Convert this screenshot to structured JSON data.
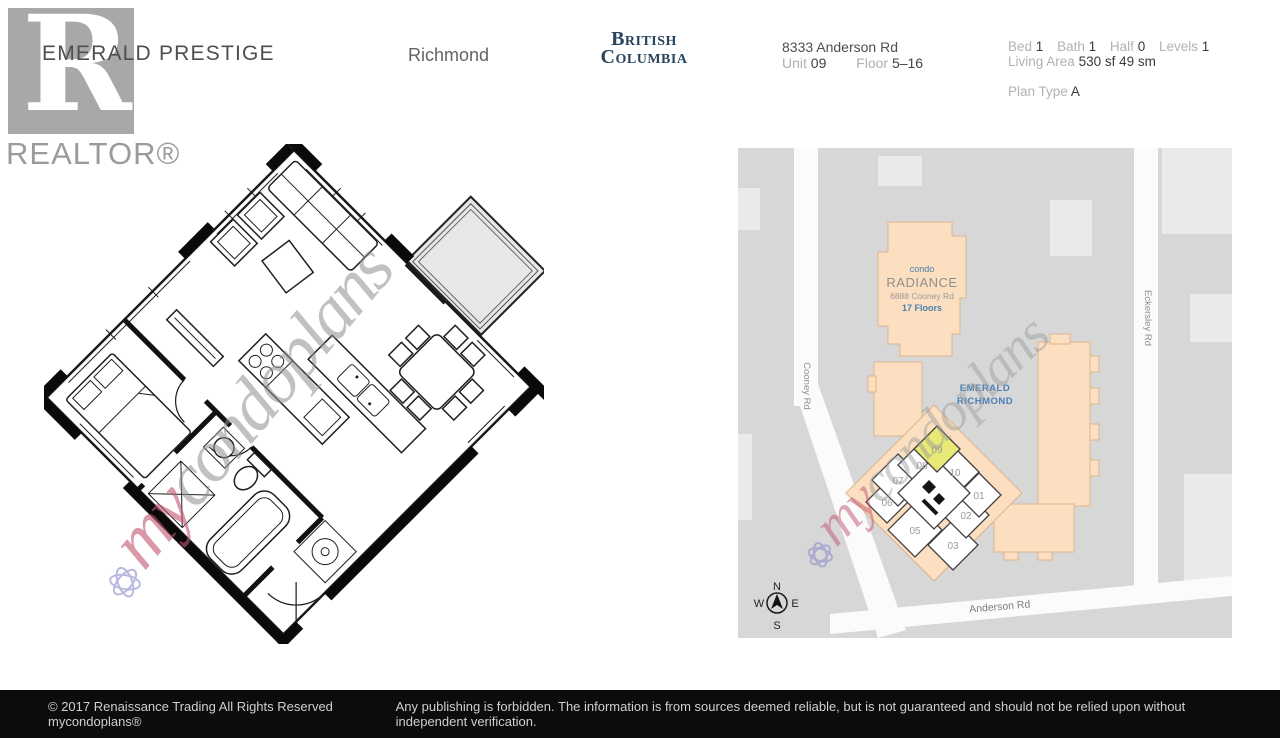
{
  "header": {
    "realtor_r": "R",
    "realtor_label": "REALTOR®",
    "title": "EMERALD PRESTIGE",
    "city": "Richmond",
    "province_line1": "British",
    "province_line2": "Columbia",
    "address": "8333 Anderson Rd",
    "unit": {
      "label": "Unit",
      "value": "09"
    },
    "floor": {
      "label": "Floor",
      "value": "5–16"
    },
    "stats": [
      {
        "label": "Bed",
        "value": "1"
      },
      {
        "label": "Bath",
        "value": "1"
      },
      {
        "label": "Half",
        "value": "0"
      },
      {
        "label": "Levels",
        "value": "1"
      }
    ],
    "living_area": {
      "label": "Living Area",
      "sf": "530 sf",
      "sm": "49 sm"
    },
    "plan_type": {
      "label": "Plan Type",
      "value": "A"
    }
  },
  "watermark": {
    "prefix": "my",
    "suffix": "condoplans"
  },
  "map": {
    "condo_label": "condo",
    "condo_name": "RADIANCE",
    "condo_address": "6888 Cooney Rd",
    "condo_floors": "17 Floors",
    "site_line1": "EMERALD",
    "site_line2": "RICHMOND",
    "roads": {
      "west": "Cooney Rd",
      "east": "Eckersley Rd",
      "south": "Anderson Rd"
    },
    "units": [
      "07",
      "08",
      "09",
      "10",
      "01",
      "06",
      "02",
      "05",
      "03"
    ],
    "highlighted_unit": "09",
    "compass": {
      "n": "N",
      "e": "E",
      "s": "S",
      "w": "W"
    },
    "colors": {
      "map_bg": "#d7d7d7",
      "road": "#fbfbfb",
      "building_light": "#eaeaea",
      "building_peach": "#fbdfc0",
      "peach_border": "#dcb48c",
      "highlight": "#e8e876",
      "label_blue": "#4a7fb5"
    }
  },
  "footer": {
    "left": "© 2017  Renaissance Trading  All Rights Reserved  mycondoplans®",
    "right": "Any publishing is forbidden.  The information is from sources deemed reliable, but is not guaranteed and should not be relied upon without independent verification."
  }
}
